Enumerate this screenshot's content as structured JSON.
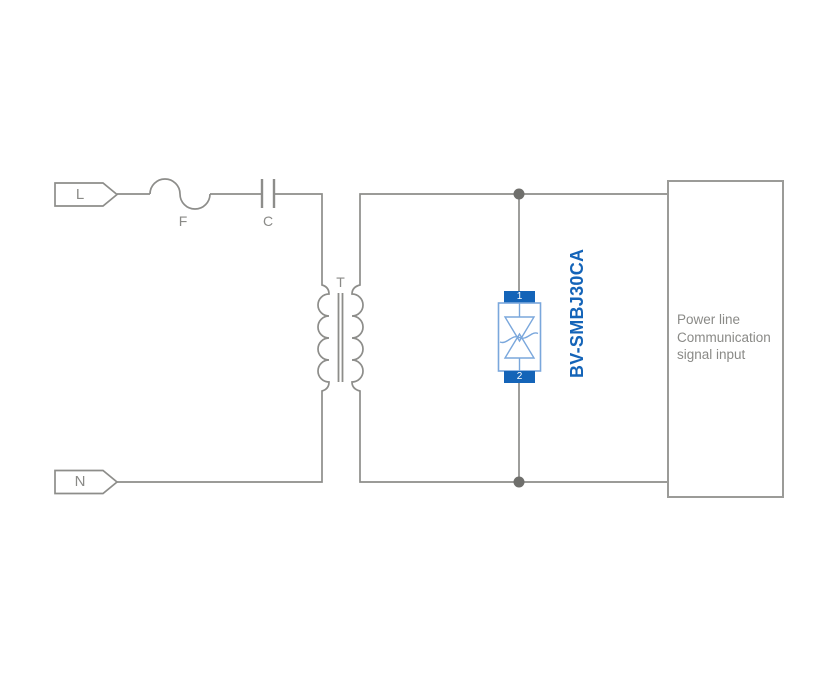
{
  "terminals": {
    "line_label": "L",
    "neutral_label": "N"
  },
  "components": {
    "fuse_label": "F",
    "capacitor_label": "C",
    "transformer_label": "T",
    "tvs_part_number": "BV-SMBJ30CA",
    "tvs_pin1": "1",
    "tvs_pin2": "2"
  },
  "load_box": {
    "lines": [
      "Power line",
      "Communication",
      "signal input"
    ]
  },
  "colors": {
    "wire": "#8d8d8a",
    "text": "#8a8a87",
    "blue_solid": "#1464b8",
    "blue_light": "#7aa7dc",
    "junction": "#6f6f6c",
    "box_border": "#9b9b98"
  }
}
